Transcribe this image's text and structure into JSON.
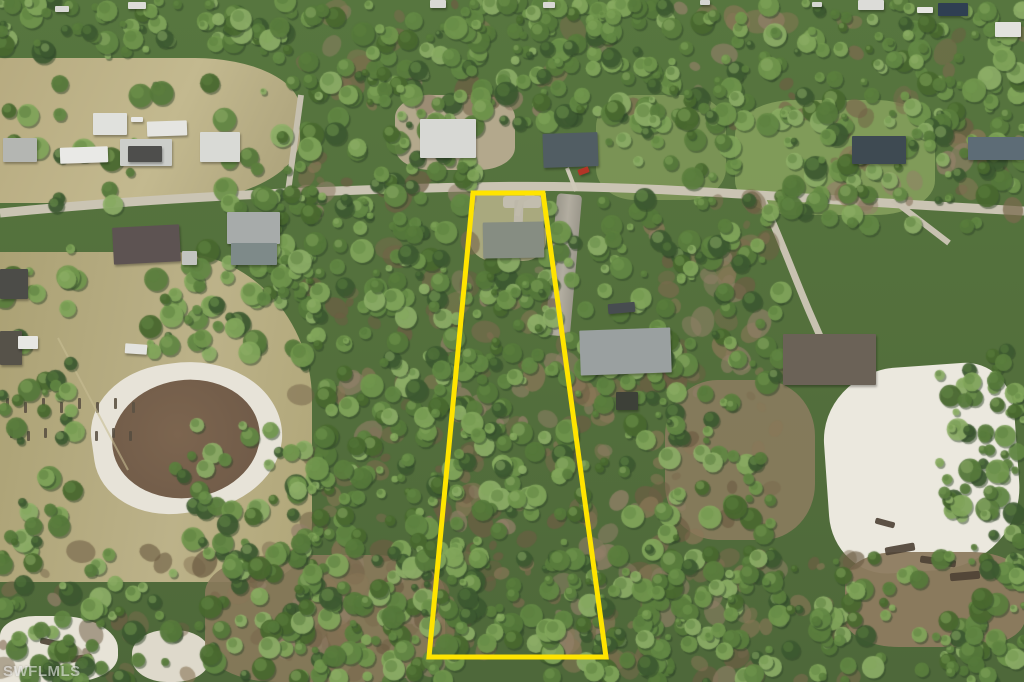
{
  "image": {
    "title": "Aerial drone photo of a wooded residential acreage lot with highlighted property boundary",
    "width": 1024,
    "height": 682
  },
  "watermark": {
    "text": "SWFLMLS"
  },
  "boundary": {
    "color": "#ffe400",
    "stroke_width": 5,
    "points": "473,193 543,193 606,657 429,657"
  },
  "palette": {
    "forest_base": "#57763f",
    "forest_dark": "#3d5a31",
    "forest_light": "#84a85c",
    "field_tan": "#b1a77b",
    "sand_white": "#eae7dc",
    "dirt_brown": "#8a7758",
    "road_gray": "#cac4b3",
    "pond_brown": "#7b644f"
  }
}
